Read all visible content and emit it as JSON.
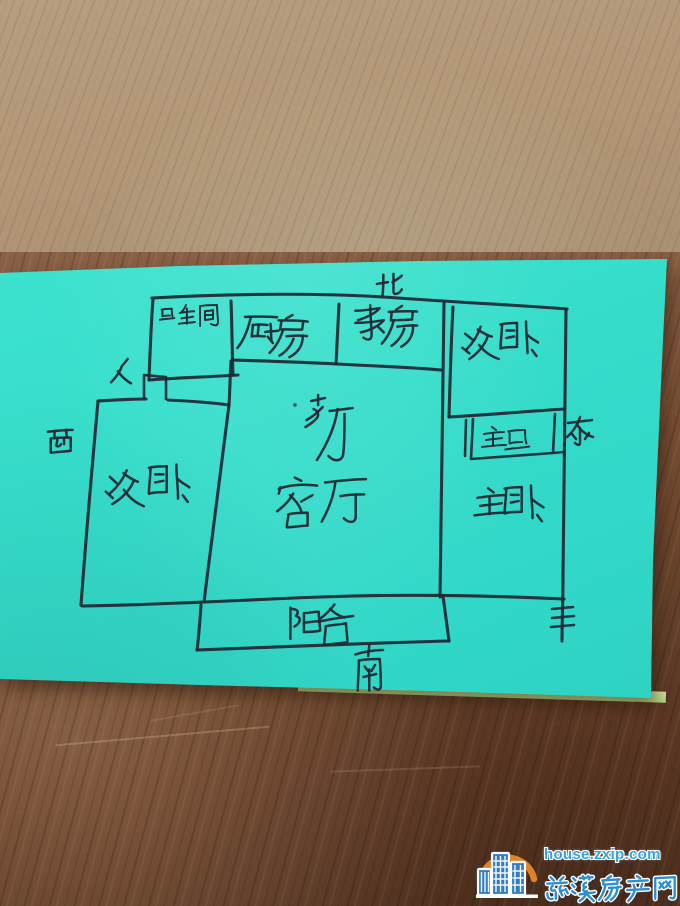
{
  "photo": {
    "note_color": "#37e0cd",
    "ink_color": "#222a33",
    "desk_upper_wood": "#b49a7c",
    "desk_lower_wood": "#6f4830"
  },
  "floor_plan": {
    "compass": {
      "north": "北",
      "south": "南",
      "east": "东",
      "west": "西"
    },
    "rooms": {
      "bathroom": "卫生间",
      "kitchen": "厨房",
      "study": "书房",
      "bedroom_northeast": "次卧",
      "master_bathroom": "主卫",
      "master_bedroom": "主卧",
      "bedroom_west": "次卧",
      "dining": "餐厅",
      "living_room": "客厅",
      "balcony": "阳台"
    },
    "entry_door_mark": "门"
  },
  "watermark": {
    "domain": "house.zxip.com",
    "site_name": "慈溪房产网",
    "brand_blue": "#2d8fd2",
    "brand_orange": "#ee8a28"
  }
}
